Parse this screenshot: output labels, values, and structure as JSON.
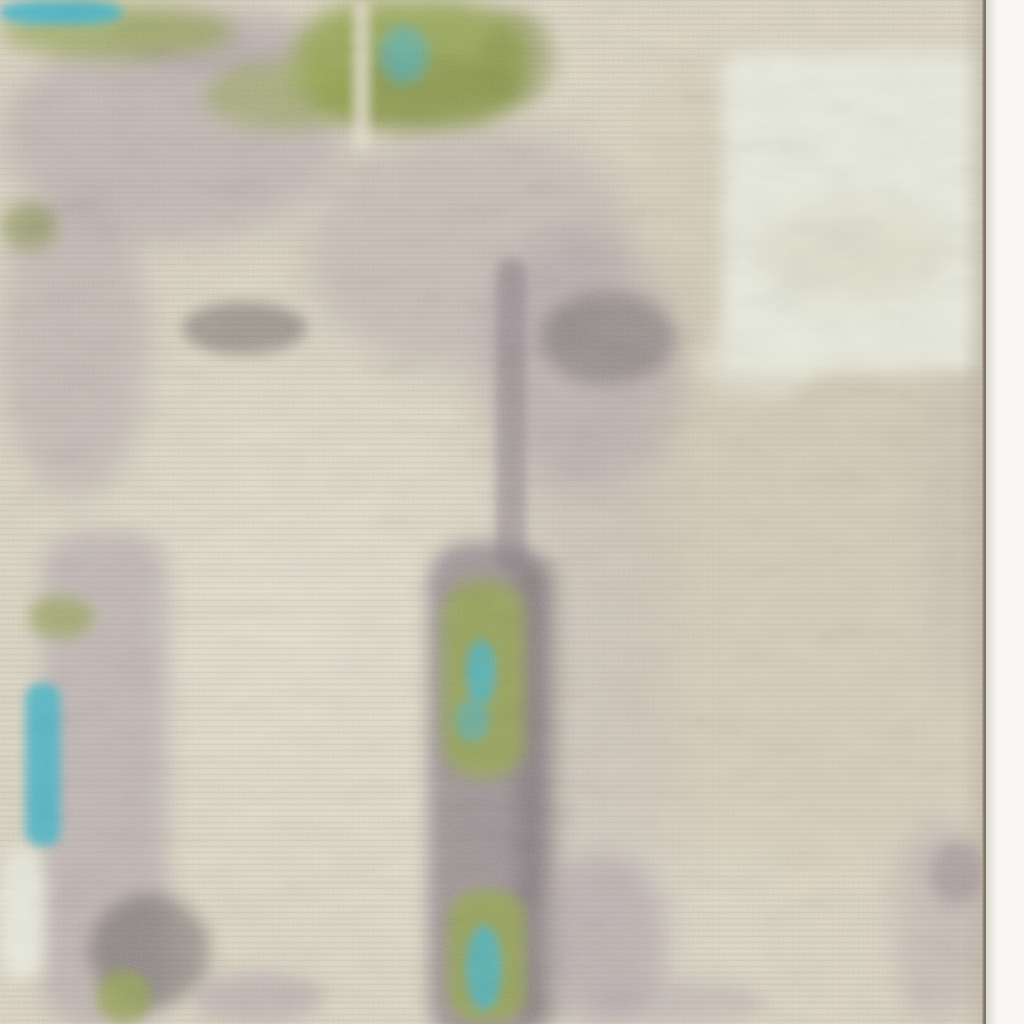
{
  "scene": {
    "type": "photograph",
    "subject": "close-up of an abstract-pattern area rug",
    "description": "Beige distressed rug with a moss-green mottled band along the top, turquoise accents, mauve and charcoal speckled washes, a pale cream patch at the upper right, a vertical green-and-teal strip running down the center-bottom, and the rug's bound edge visible against a white backdrop along the right side.",
    "has_text": false
  },
  "palette": {
    "beige": "#d7d0bd",
    "beige_dark": "#cfc6b0",
    "beige_light": "#e0dac9",
    "cream": "#e7e9dc",
    "moss_green": "#94a455",
    "olive_green": "#7d8a48",
    "turquoise": "#4fb3c4",
    "mauve": "#a89ba3",
    "gray_purple": "#897e86",
    "charcoal": "#575156",
    "backdrop": "#f8f7f3",
    "edge_line": "#8a7f72"
  },
  "layout": {
    "rug_width_px": 986,
    "edge_line_x_px": 982,
    "backdrop_strip_width_px": 38,
    "image_size_px": 1024
  },
  "regions": [
    {
      "name": "beige-dark-wash-right",
      "x": 640,
      "y": 70,
      "w": 345,
      "h": 780,
      "color": "beige_dark",
      "blur": 30,
      "opacity": 0.5,
      "radius": "80px"
    },
    {
      "name": "lavender-wash-column",
      "x": 500,
      "y": 370,
      "w": 170,
      "h": 650,
      "color": "mauve",
      "blur": 26,
      "opacity": 0.22,
      "radius": "60px"
    },
    {
      "name": "mauve-field-top-left",
      "x": 0,
      "y": 28,
      "w": 345,
      "h": 215,
      "color": "mauve",
      "blur": 18,
      "opacity": 0.5,
      "radius": "50%"
    },
    {
      "name": "mauve-left-column",
      "x": 0,
      "y": 190,
      "w": 150,
      "h": 310,
      "color": "mauve",
      "blur": 16,
      "opacity": 0.45,
      "radius": "50%"
    },
    {
      "name": "mauve-diagonal-wash",
      "x": 305,
      "y": 125,
      "w": 325,
      "h": 245,
      "color": "mauve",
      "blur": 20,
      "opacity": 0.4,
      "radius": "50%",
      "rotate": -10
    },
    {
      "name": "mauve-blotch-center",
      "x": 480,
      "y": 235,
      "w": 205,
      "h": 255,
      "color": "mauve",
      "blur": 18,
      "opacity": 0.45,
      "radius": "50%"
    },
    {
      "name": "mauve-wash-right-mid",
      "x": 922,
      "y": 355,
      "w": 64,
      "h": 330,
      "color": "mauve",
      "blur": 18,
      "opacity": 0.2,
      "radius": "40%"
    },
    {
      "name": "mauve-wash-right-low",
      "x": 894,
      "y": 822,
      "w": 92,
      "h": 202,
      "color": "mauve",
      "blur": 15,
      "opacity": 0.38,
      "radius": "40%"
    },
    {
      "name": "mauve-gap-top",
      "x": 115,
      "y": 10,
      "w": 210,
      "h": 65,
      "color": "mauve",
      "blur": 12,
      "opacity": 0.5,
      "radius": "50%"
    },
    {
      "name": "green-band-top-left",
      "x": 0,
      "y": 4,
      "w": 235,
      "h": 55,
      "color": "moss_green",
      "blur": 10,
      "opacity": 0.7,
      "radius": "50%"
    },
    {
      "name": "green-band-top-mid",
      "x": 295,
      "y": 0,
      "w": 235,
      "h": 125,
      "color": "moss_green",
      "blur": 11,
      "opacity": 0.9,
      "radius": "40%"
    },
    {
      "name": "olive-shade-mid",
      "x": 320,
      "y": 55,
      "w": 195,
      "h": 75,
      "color": "olive_green",
      "blur": 10,
      "opacity": 0.5,
      "radius": "50%"
    },
    {
      "name": "green-ledge-mid",
      "x": 205,
      "y": 60,
      "w": 160,
      "h": 70,
      "color": "moss_green",
      "blur": 10,
      "opacity": 0.55,
      "radius": "50%"
    },
    {
      "name": "olive-fleck-row",
      "x": 480,
      "y": 10,
      "w": 75,
      "h": 95,
      "color": "olive_green",
      "blur": 9,
      "opacity": 0.45,
      "radius": "50%"
    },
    {
      "name": "teal-patch-top-left",
      "x": 0,
      "y": 0,
      "w": 122,
      "h": 25,
      "color": "turquoise",
      "blur": 5,
      "opacity": 0.95,
      "radius": "40%"
    },
    {
      "name": "teal-spot-top-mid",
      "x": 380,
      "y": 26,
      "w": 48,
      "h": 58,
      "color": "turquoise",
      "blur": 7,
      "opacity": 0.6,
      "radius": "50%"
    },
    {
      "name": "olive-smudge-left-edge",
      "x": 0,
      "y": 202,
      "w": 58,
      "h": 48,
      "color": "olive_green",
      "blur": 8,
      "opacity": 0.55,
      "radius": "50%"
    },
    {
      "name": "charcoal-cluster-left",
      "x": 182,
      "y": 302,
      "w": 125,
      "h": 52,
      "color": "charcoal",
      "blur": 7,
      "opacity": 0.45,
      "radius": "50%"
    },
    {
      "name": "charcoal-cluster-center",
      "x": 540,
      "y": 292,
      "w": 135,
      "h": 92,
      "color": "charcoal",
      "blur": 9,
      "opacity": 0.38,
      "radius": "50%"
    },
    {
      "name": "pale-streak-top",
      "x": 353,
      "y": 0,
      "w": 17,
      "h": 150,
      "color": "beige_light",
      "blur": 5,
      "opacity": 0.8,
      "radius": "8px"
    },
    {
      "name": "cream-patch-top-right",
      "x": 722,
      "y": 50,
      "w": 258,
      "h": 322,
      "color": "cream",
      "blur": 9,
      "opacity": 0.95,
      "radius": "18px"
    },
    {
      "name": "beige-erosion-in-cream",
      "x": 756,
      "y": 205,
      "w": 195,
      "h": 95,
      "color": "beige",
      "blur": 12,
      "opacity": 0.5,
      "radius": "50%"
    },
    {
      "name": "cream-tail-bottom-left",
      "x": 698,
      "y": 325,
      "w": 125,
      "h": 75,
      "color": "cream",
      "blur": 10,
      "opacity": 0.5,
      "radius": "50%"
    },
    {
      "name": "gray-streak-vertical",
      "x": 496,
      "y": 258,
      "w": 30,
      "h": 315,
      "color": "gray_purple",
      "blur": 5,
      "opacity": 0.55,
      "radius": "15px"
    },
    {
      "name": "purple-column-mid",
      "x": 428,
      "y": 542,
      "w": 118,
      "h": 500,
      "color": "gray_purple",
      "blur": 9,
      "opacity": 0.75,
      "radius": "40px"
    },
    {
      "name": "charcoal-column-edge",
      "x": 518,
      "y": 558,
      "w": 42,
      "h": 470,
      "color": "charcoal",
      "blur": 10,
      "opacity": 0.3,
      "radius": "20px"
    },
    {
      "name": "green-column-patch",
      "x": 443,
      "y": 580,
      "w": 82,
      "h": 198,
      "color": "moss_green",
      "blur": 8,
      "opacity": 0.85,
      "radius": "35px"
    },
    {
      "name": "teal-fleck-column-1",
      "x": 466,
      "y": 640,
      "w": 30,
      "h": 64,
      "color": "turquoise",
      "blur": 5,
      "opacity": 0.8,
      "radius": "50%"
    },
    {
      "name": "teal-fleck-column-2",
      "x": 456,
      "y": 698,
      "w": 34,
      "h": 44,
      "color": "turquoise",
      "blur": 5,
      "opacity": 0.55,
      "radius": "50%"
    },
    {
      "name": "green-column-bottom",
      "x": 448,
      "y": 890,
      "w": 78,
      "h": 132,
      "color": "moss_green",
      "blur": 7,
      "opacity": 0.85,
      "radius": "30px"
    },
    {
      "name": "teal-fleck-bottom",
      "x": 466,
      "y": 925,
      "w": 36,
      "h": 86,
      "color": "turquoise",
      "blur": 5,
      "opacity": 0.8,
      "radius": "50%"
    },
    {
      "name": "mauve-widen-bottom",
      "x": 536,
      "y": 855,
      "w": 130,
      "h": 168,
      "color": "mauve",
      "blur": 12,
      "opacity": 0.5,
      "radius": "50%"
    },
    {
      "name": "purple-strip-left",
      "x": 42,
      "y": 532,
      "w": 126,
      "h": 492,
      "color": "mauve",
      "blur": 12,
      "opacity": 0.55,
      "radius": "40px"
    },
    {
      "name": "green-spot-left",
      "x": 28,
      "y": 596,
      "w": 66,
      "h": 42,
      "color": "moss_green",
      "blur": 7,
      "opacity": 0.65,
      "radius": "50%"
    },
    {
      "name": "teal-bar-left",
      "x": 25,
      "y": 683,
      "w": 36,
      "h": 164,
      "color": "turquoise",
      "blur": 5,
      "opacity": 0.9,
      "radius": "16px"
    },
    {
      "name": "cream-patch-left-bottom",
      "x": 0,
      "y": 850,
      "w": 44,
      "h": 128,
      "color": "cream",
      "blur": 8,
      "opacity": 0.9,
      "radius": "30%"
    },
    {
      "name": "charcoal-cluster-bottom-left",
      "x": 90,
      "y": 894,
      "w": 120,
      "h": 114,
      "color": "charcoal",
      "blur": 9,
      "opacity": 0.45,
      "radius": "50%"
    },
    {
      "name": "green-fleck-bottom-left",
      "x": 96,
      "y": 970,
      "w": 56,
      "h": 54,
      "color": "moss_green",
      "blur": 6,
      "opacity": 0.75,
      "radius": "50%"
    },
    {
      "name": "mauve-speckle-bottom-1",
      "x": 192,
      "y": 972,
      "w": 132,
      "h": 52,
      "color": "mauve",
      "blur": 9,
      "opacity": 0.5,
      "radius": "50%"
    },
    {
      "name": "mauve-speckle-bottom-2",
      "x": 592,
      "y": 980,
      "w": 175,
      "h": 44,
      "color": "mauve",
      "blur": 10,
      "opacity": 0.4,
      "radius": "50%"
    },
    {
      "name": "mauve-speckle-right-edge-top",
      "x": 930,
      "y": 842,
      "w": 56,
      "h": 62,
      "color": "gray_purple",
      "blur": 8,
      "opacity": 0.45,
      "radius": "50%"
    }
  ]
}
